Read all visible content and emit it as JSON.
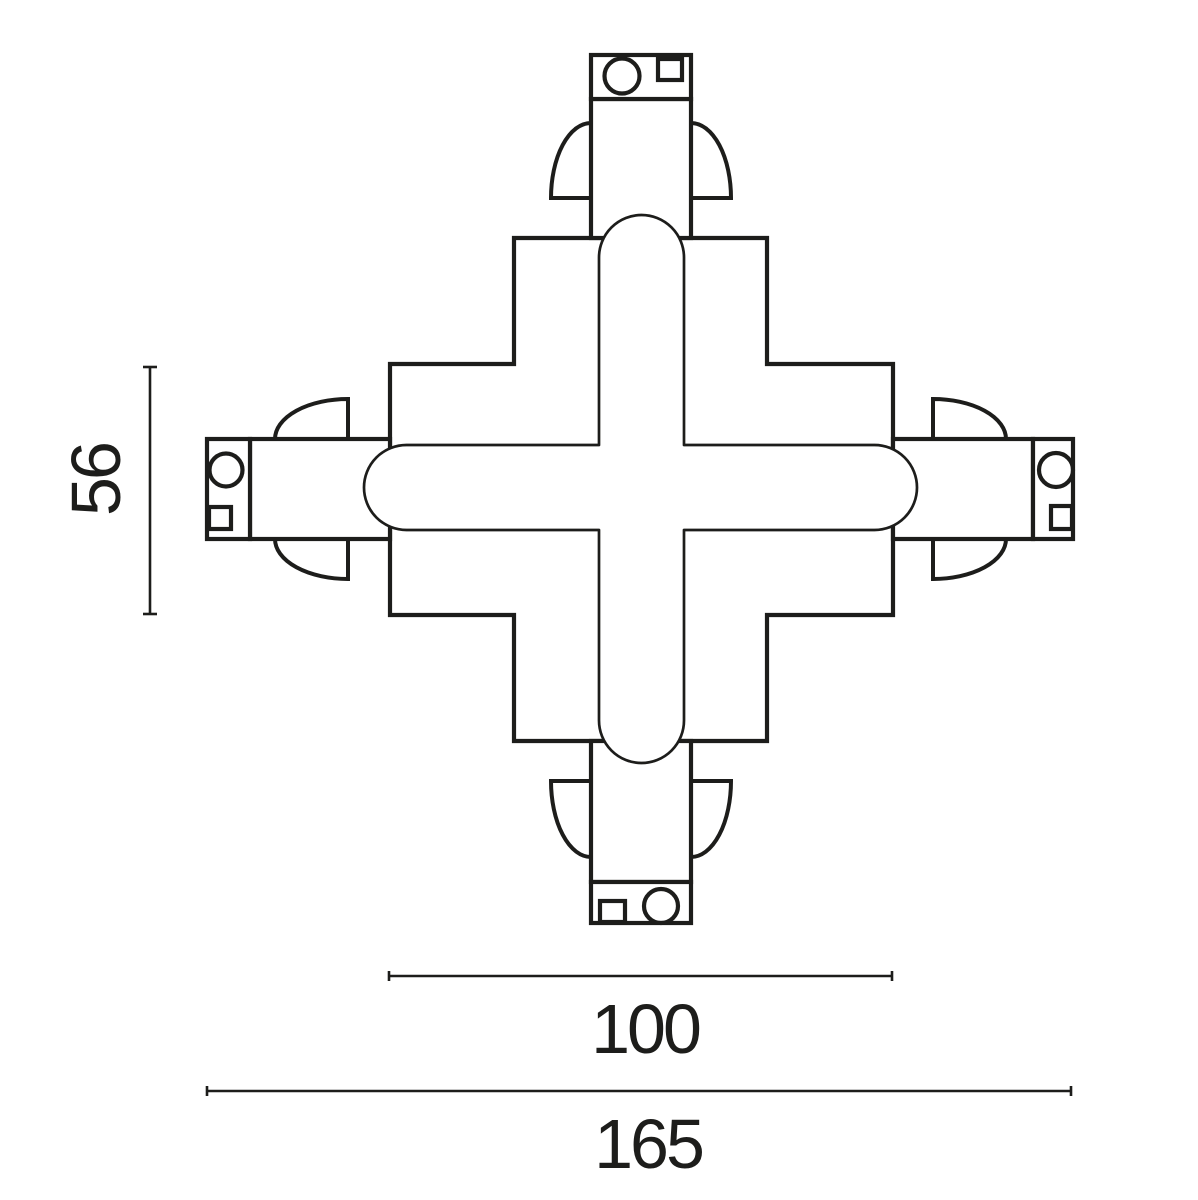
{
  "drawing": {
    "subject": "cross-track-connector-top-view",
    "background_color": "#ffffff",
    "line_color": "#1d1d1b",
    "dimensions": {
      "connector_height": {
        "value": "56",
        "orientation": "vertical"
      },
      "body_width": {
        "value": "100",
        "orientation": "horizontal"
      },
      "overall_width": {
        "value": "165",
        "orientation": "horizontal"
      }
    }
  }
}
